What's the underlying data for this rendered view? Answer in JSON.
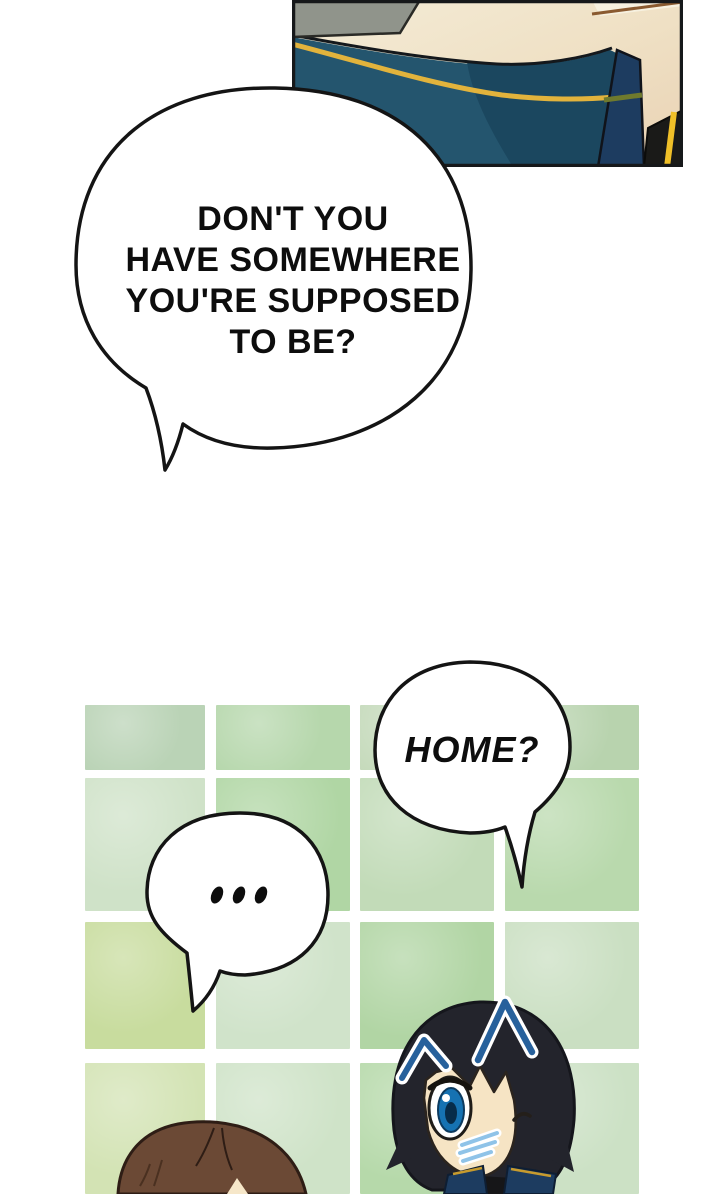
{
  "bubbles": {
    "main": {
      "lines": [
        "DON'T YOU",
        "HAVE SOMEWHERE",
        "YOU'RE SUPPOSED",
        "TO BE?"
      ]
    },
    "home": {
      "text": "HOME?"
    },
    "silence": {
      "text": "..."
    }
  },
  "colors": {
    "background": "#ffffff",
    "bubble_fill": "#ffffff",
    "bubble_outline": "#141414",
    "text": "#0d0d0d",
    "uniform_teal": "#24556e",
    "uniform_teal_dark": "#1b475f",
    "gold_braid": "#e2b33c",
    "navy_collar": "#1d3c60",
    "olive_stripe": "#6f7a2d",
    "yellow_stripe": "#f0c028",
    "panel_cream": "#f4ecd7",
    "panel_tan": "#e9d2b4",
    "panel_gray": "#90948b",
    "panel_border": "#16181a",
    "hair_black": "#23242c",
    "hair_brown": "#6b4935",
    "skin": "#f6e4c4",
    "eye_blue": "#1672b2",
    "surprise_mark_blue": "#27619c",
    "blush_blue": "#8fc3e8"
  },
  "tile_wall": {
    "x": [
      85,
      216,
      360,
      505
    ],
    "widths": [
      120,
      134,
      134,
      134
    ],
    "y": [
      705,
      778,
      922,
      1063
    ],
    "heights": [
      65,
      133,
      127,
      131
    ],
    "colors": [
      [
        "#bad3b6",
        "#b6d7ac",
        "#c5dabb",
        "#b8d3ae"
      ],
      [
        "#cfe2c8",
        "#b0d6a4",
        "#c2dbb8",
        "#b9d9ad"
      ],
      [
        "#c8dc9e",
        "#d0e3ca",
        "#b1d5a4",
        "#cadfc2"
      ],
      [
        "#d3e3b4",
        "#cfe3c8",
        "#b6d9aa",
        "#cce1c5"
      ]
    ]
  }
}
